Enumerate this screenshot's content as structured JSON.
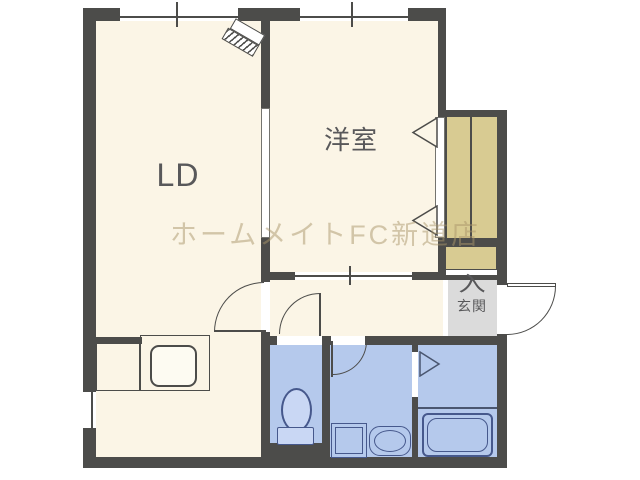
{
  "title": "1LDK apartment floor plan",
  "labels": {
    "living_dining": "LD",
    "western_room": "洋室",
    "entrance": "玄関",
    "entrance_mark": "入",
    "watermark": "ホームメイトFC新道店"
  },
  "colors": {
    "wall": "#4C4C4A",
    "floor": "#FBF5E6",
    "wet": "#B5C9EC",
    "fixture": "#46588C",
    "closet": "#D8CB92",
    "entrance_floor": "#DBDBDB",
    "text": "#58585A",
    "watermark": "rgba(170,150,105,0.5)"
  }
}
